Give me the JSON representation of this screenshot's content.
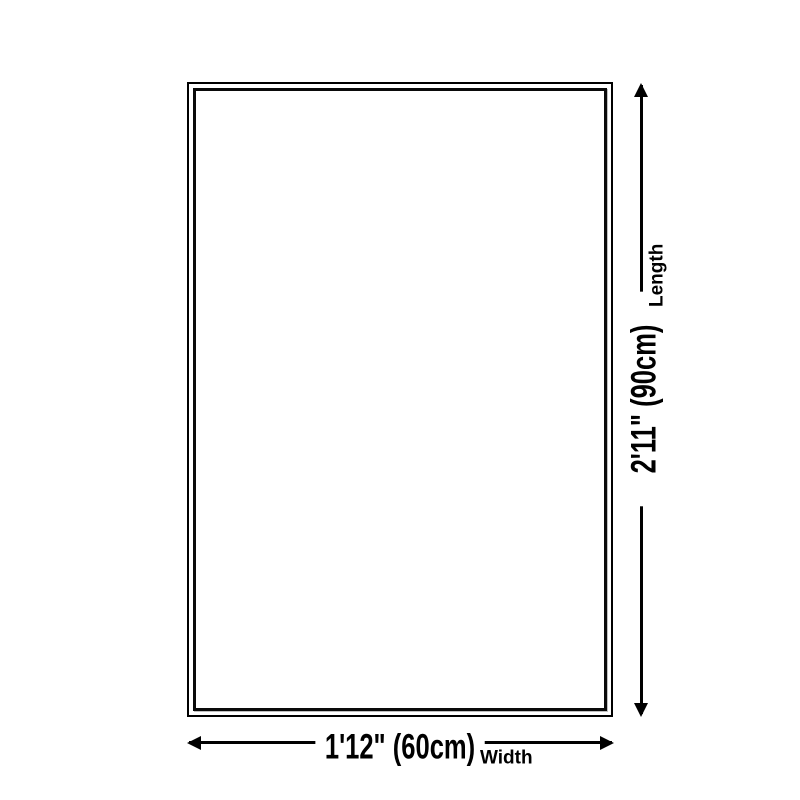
{
  "diagram": {
    "background_color": "#ffffff",
    "line_color": "#000000",
    "text_color": "#000000",
    "rug": {
      "fill_color": "#ffffff",
      "border_color": "#000000",
      "border_style": "double"
    },
    "length": {
      "value": "2'11\" (90cm)",
      "label": "Length"
    },
    "width": {
      "value": "1'12\" (60cm)",
      "label": "Width"
    }
  }
}
